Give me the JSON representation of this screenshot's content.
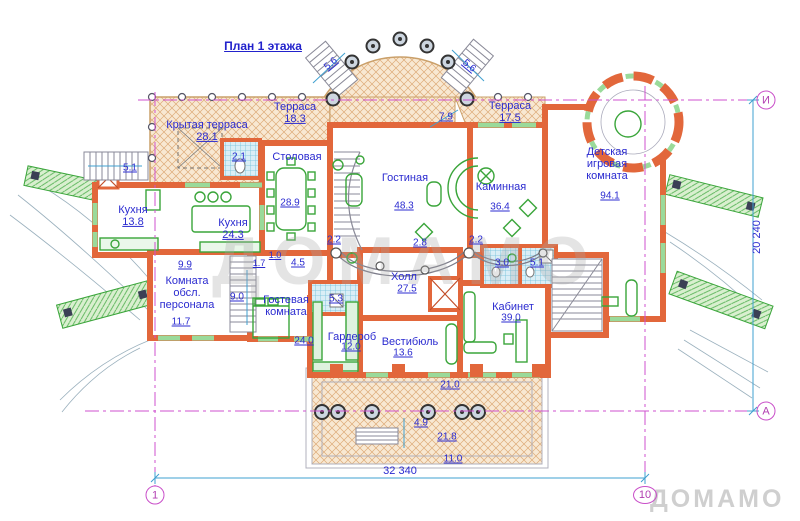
{
  "title": "План 1 этажа",
  "rooms": [
    {
      "name": "Терраса",
      "area": "18.3"
    },
    {
      "name": "Крытая терраса",
      "area": "28.1"
    },
    {
      "name": "Терраса",
      "area": "17.5"
    },
    {
      "name": "Столовая",
      "area": "28.9"
    },
    {
      "name": "Гостиная",
      "area": "48.3"
    },
    {
      "name": "Каминная",
      "area": "36.4"
    },
    {
      "name": "Детская игровая комната",
      "area": "94.1"
    },
    {
      "name": "Кухня",
      "area": "13.8"
    },
    {
      "name": "Кухня",
      "area": "24.3"
    },
    {
      "name": "Комната обсл. персонала",
      "area": "11.7"
    },
    {
      "name": "Гостевая комната",
      "area": "24.0"
    },
    {
      "name": "Гардероб",
      "area": "12.0"
    },
    {
      "name": "Вестибюль",
      "area": "13.6"
    },
    {
      "name": "Холл",
      "area": "27.5"
    },
    {
      "name": "Кабинет",
      "area": "39.0"
    }
  ],
  "dims": {
    "width_total": "32 340",
    "height_total": "20 240",
    "stair_top_left": "5.6",
    "stair_top_right": "5.6",
    "terrace_right": "7.9",
    "bath_dining": "2.1",
    "stair_left": "5.1",
    "corridor_kitchen": "9.9",
    "corridor_small_a": "1.0",
    "corridor_small_b": "1.7",
    "corridor_guest": "4.5",
    "stair_service": "9.0",
    "bath_guest": "5.3",
    "gallery_left": "2.2",
    "gallery_mid": "2.8",
    "gallery_right": "2.2",
    "bath_hall_a": "3.0",
    "bath_hall_b": "5.1",
    "terrace_bottom_a": "21.0",
    "steps_bottom": "4.9",
    "terrace_bottom_b": "21.8",
    "terrace_bottom_c": "11.0"
  },
  "axes": {
    "horiz_top": "И",
    "horiz_bottom": "А",
    "vert_left": "1",
    "vert_right": "10"
  },
  "watermark": {
    "center": "ДОМАМО",
    "corner": "ДОМАМО"
  },
  "colors": {
    "wall": "#e2673b",
    "label": "#2b2bd0",
    "axis": "#c94fc9",
    "dimension": "#3fa0d0",
    "furniture": "#3aa53a",
    "terrace_bg": "#f8e8d2",
    "tile_bg": "#daeef6"
  }
}
